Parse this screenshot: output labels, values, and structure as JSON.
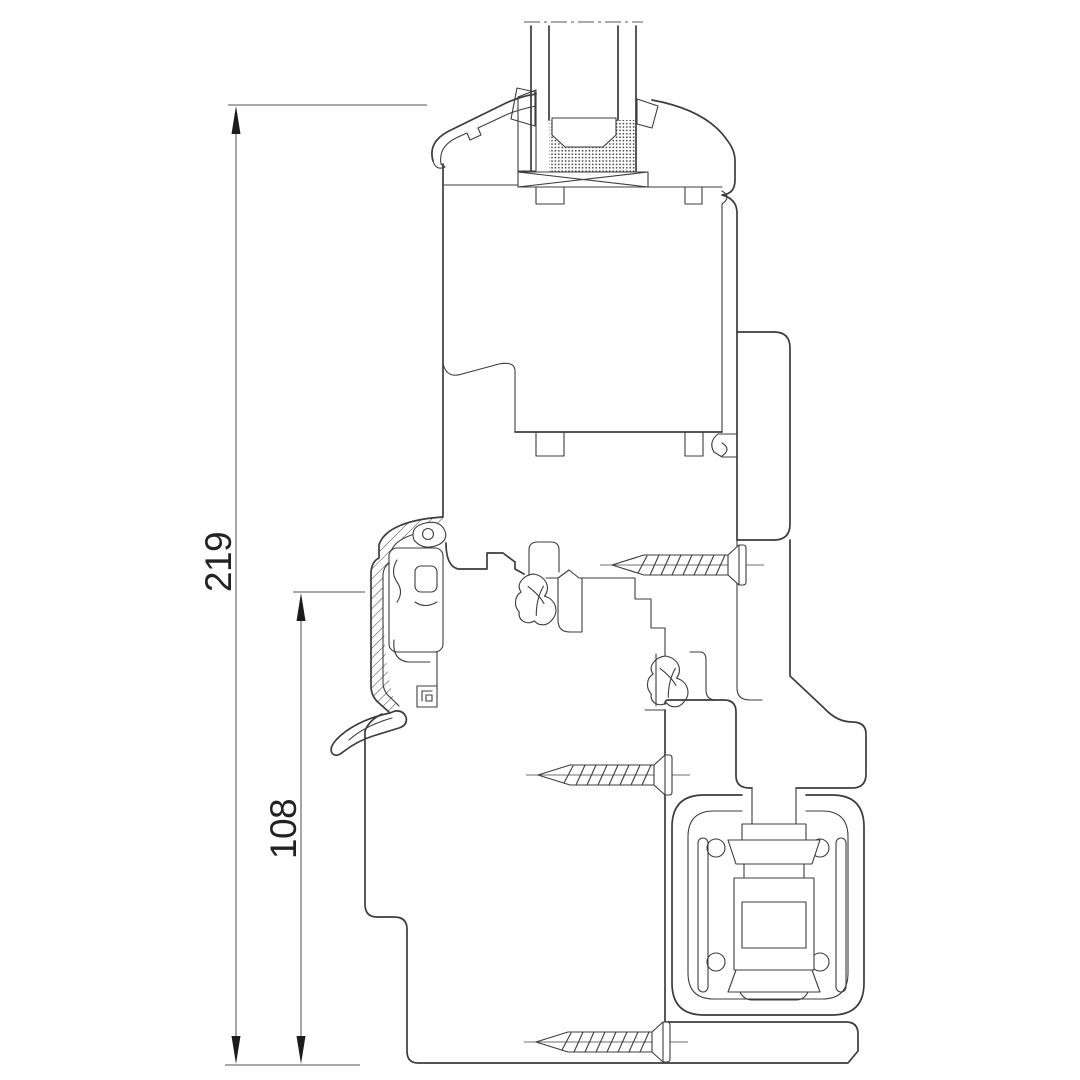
{
  "drawing_kind": "window-profile-cross-section",
  "dimensions": {
    "total_height": {
      "label": "219"
    },
    "lower_height": {
      "label": "108"
    }
  },
  "colors": {
    "background": "#ffffff",
    "line": "#3c3c3c",
    "dimension_line": "#757575",
    "extension_line": "#8c8c8c",
    "arrow": "#1c1c1c",
    "text": "#222222"
  }
}
